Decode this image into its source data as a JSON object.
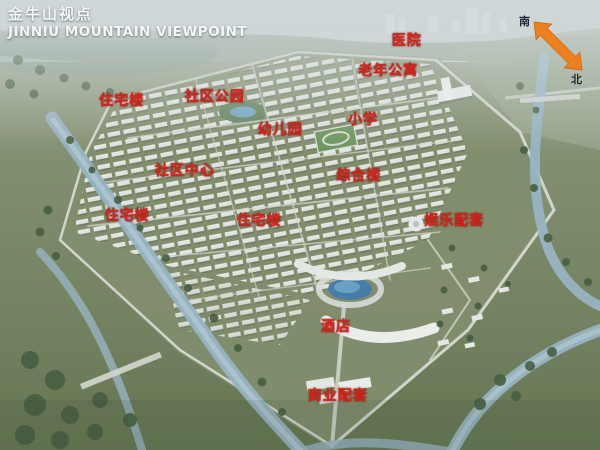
{
  "title": {
    "zh": "金牛山视点",
    "en": "JINNIU MOUNTAIN VIEWPOINT"
  },
  "compass": {
    "south": "南",
    "north": "北"
  },
  "colors": {
    "label_red": "#d8251c",
    "arrow_orange": "#ec8020",
    "title_white": "#f4f7f6",
    "water_blue": "#93b2c2",
    "pond_blue": "#3e78a6"
  },
  "map_labels": [
    {
      "id": "hospital",
      "text": "医院",
      "x": 67.8,
      "y": 8.9
    },
    {
      "id": "senior-apartments",
      "text": "老年公寓",
      "x": 64.7,
      "y": 15.6
    },
    {
      "id": "residential-1",
      "text": "住宅楼",
      "x": 20.3,
      "y": 22.2
    },
    {
      "id": "community-park",
      "text": "社区公园",
      "x": 35.8,
      "y": 21.3
    },
    {
      "id": "kindergarten",
      "text": "幼儿园",
      "x": 46.7,
      "y": 28.7
    },
    {
      "id": "primary-school",
      "text": "小学",
      "x": 60.5,
      "y": 26.4
    },
    {
      "id": "community-center",
      "text": "社区中心",
      "x": 30.8,
      "y": 37.8
    },
    {
      "id": "complex-building",
      "text": "综合楼",
      "x": 59.8,
      "y": 38.9
    },
    {
      "id": "residential-2",
      "text": "住宅楼",
      "x": 21.2,
      "y": 47.8
    },
    {
      "id": "residential-3",
      "text": "住宅楼",
      "x": 43.2,
      "y": 48.9
    },
    {
      "id": "entertainment-amenities",
      "text": "娱乐配套",
      "x": 75.7,
      "y": 48.9
    },
    {
      "id": "hotel",
      "text": "酒店",
      "x": 56.0,
      "y": 72.4
    },
    {
      "id": "commercial-amenities",
      "text": "商业配套",
      "x": 56.3,
      "y": 87.8
    }
  ]
}
